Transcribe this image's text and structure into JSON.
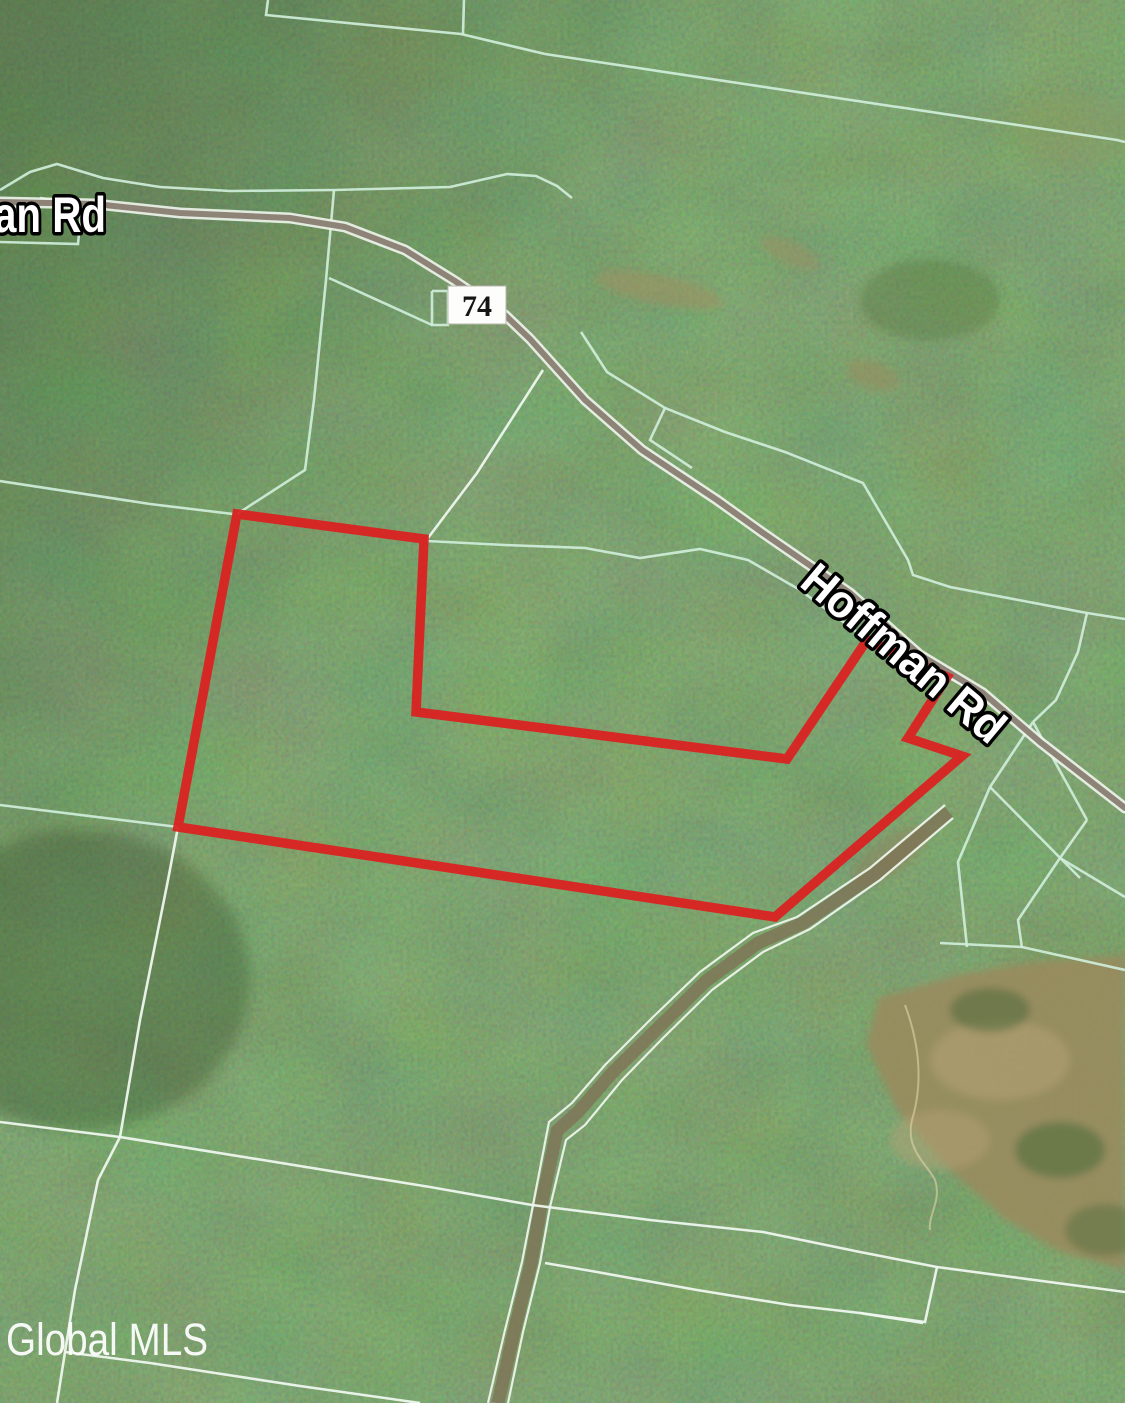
{
  "map": {
    "width": 1125,
    "height": 1403,
    "watermark": "Global MLS",
    "road_label_partial": "an Rd",
    "road_label": "Hoffman Rd",
    "route_badge": "74",
    "colors": {
      "boundary_red": "#db2121",
      "parcel_line_green": "#cfeeda",
      "parcel_line_light": "#eef7ee",
      "road_fill": "#8d8477",
      "road_casing": "#edf3ea",
      "label_fill": "#ffffff",
      "label_outline": "#000000",
      "forest_dark": "#2e4824",
      "forest_light": "#6d8f55",
      "cleared_tan": "#9a8a5e"
    },
    "red_boundary": [
      [
        237,
        514
      ],
      [
        424,
        539
      ],
      [
        416,
        712
      ],
      [
        787,
        759
      ],
      [
        867,
        640
      ],
      [
        947,
        677
      ],
      [
        908,
        738
      ],
      [
        962,
        756
      ],
      [
        775,
        917
      ],
      [
        178,
        827
      ]
    ],
    "road": [
      [
        0,
        202
      ],
      [
        95,
        204
      ],
      [
        180,
        213
      ],
      [
        290,
        218
      ],
      [
        345,
        227
      ],
      [
        405,
        250
      ],
      [
        455,
        281
      ],
      [
        505,
        315
      ],
      [
        530,
        339
      ],
      [
        585,
        400
      ],
      [
        642,
        450
      ],
      [
        717,
        500
      ],
      [
        763,
        533
      ],
      [
        850,
        593
      ],
      [
        920,
        655
      ],
      [
        983,
        693
      ],
      [
        1040,
        742
      ],
      [
        1125,
        808
      ]
    ],
    "green_lines": [
      [
        [
          0,
          190
        ],
        [
          30,
          172
        ],
        [
          57,
          164
        ],
        [
          103,
          178
        ],
        [
          160,
          187
        ],
        [
          230,
          191
        ],
        [
          334,
          190
        ],
        [
          450,
          187
        ],
        [
          507,
          174
        ],
        [
          536,
          176
        ],
        [
          557,
          186
        ],
        [
          572,
          198
        ]
      ],
      [
        [
          0,
          242
        ],
        [
          78,
          244
        ],
        [
          82,
          203
        ],
        [
          40,
          198
        ]
      ],
      [
        [
          334,
          190
        ],
        [
          326,
          280
        ],
        [
          314,
          400
        ],
        [
          305,
          470
        ],
        [
          237,
          514
        ]
      ],
      [
        [
          329,
          278
        ],
        [
          432,
          325
        ]
      ],
      [
        [
          432,
          291
        ],
        [
          448,
          291
        ],
        [
          448,
          325
        ],
        [
          432,
          325
        ],
        [
          432,
          291
        ]
      ],
      [
        [
          268,
          0
        ],
        [
          266,
          15
        ],
        [
          461,
          34
        ],
        [
          545,
          54
        ],
        [
          1117,
          140
        ],
        [
          1125,
          142
        ]
      ],
      [
        [
          464,
          0
        ],
        [
          463,
          34
        ]
      ],
      [
        [
          427,
          541
        ],
        [
          505,
          545
        ],
        [
          585,
          548
        ],
        [
          640,
          558
        ],
        [
          700,
          549
        ],
        [
          748,
          560
        ],
        [
          800,
          590
        ],
        [
          838,
          618
        ],
        [
          867,
          640
        ]
      ],
      [
        [
          947,
          677
        ],
        [
          978,
          692
        ]
      ],
      [
        [
          581,
          332
        ],
        [
          607,
          372
        ],
        [
          665,
          408
        ],
        [
          725,
          432
        ],
        [
          785,
          452
        ],
        [
          863,
          483
        ],
        [
          908,
          560
        ],
        [
          913,
          575
        ],
        [
          950,
          587
        ],
        [
          1087,
          613
        ],
        [
          1125,
          619
        ]
      ],
      [
        [
          1087,
          613
        ],
        [
          1078,
          652
        ],
        [
          1056,
          700
        ],
        [
          1033,
          722
        ]
      ],
      [
        [
          665,
          408
        ],
        [
          650,
          440
        ],
        [
          692,
          468
        ]
      ],
      [
        [
          1033,
          722
        ],
        [
          990,
          787
        ],
        [
          958,
          862
        ],
        [
          967,
          947
        ]
      ],
      [
        [
          1033,
          722
        ],
        [
          1087,
          820
        ]
      ],
      [
        [
          1087,
          820
        ],
        [
          1060,
          858
        ],
        [
          1018,
          920
        ],
        [
          1022,
          948
        ]
      ],
      [
        [
          990,
          787
        ],
        [
          1080,
          878
        ]
      ],
      [
        [
          1060,
          858
        ],
        [
          1125,
          897
        ]
      ],
      [
        [
          940,
          943
        ],
        [
          1022,
          947
        ],
        [
          1125,
          970
        ]
      ],
      [
        [
          0,
          481
        ],
        [
          150,
          504
        ],
        [
          233,
          514
        ]
      ],
      [
        [
          0,
          805
        ],
        [
          178,
          827
        ]
      ]
    ],
    "white_lines": [
      [
        [
          543,
          370
        ],
        [
          477,
          473
        ],
        [
          428,
          538
        ]
      ],
      [
        [
          178,
          827
        ],
        [
          168,
          880
        ],
        [
          140,
          1020
        ],
        [
          120,
          1137
        ]
      ],
      [
        [
          0,
          1122
        ],
        [
          120,
          1137
        ],
        [
          430,
          1187
        ],
        [
          532,
          1205
        ],
        [
          650,
          1220
        ],
        [
          763,
          1232
        ],
        [
          860,
          1252
        ],
        [
          937,
          1267
        ],
        [
          1125,
          1292
        ]
      ],
      [
        [
          545,
          1263
        ],
        [
          597,
          1272
        ],
        [
          697,
          1290
        ],
        [
          790,
          1305
        ],
        [
          860,
          1313
        ],
        [
          923,
          1323
        ]
      ],
      [
        [
          937,
          1267
        ],
        [
          925,
          1322
        ],
        [
          860,
          1313
        ]
      ],
      [
        [
          120,
          1137
        ],
        [
          98,
          1180
        ],
        [
          75,
          1290
        ],
        [
          65,
          1352
        ],
        [
          57,
          1403
        ]
      ],
      [
        [
          65,
          1352
        ],
        [
          150,
          1363
        ],
        [
          300,
          1386
        ],
        [
          420,
          1403
        ]
      ]
    ],
    "trail_center": [
      [
        949,
        812
      ],
      [
        875,
        874
      ],
      [
        803,
        923
      ],
      [
        758,
        943
      ],
      [
        706,
        981
      ],
      [
        658,
        1028
      ],
      [
        613,
        1072
      ],
      [
        578,
        1112
      ],
      [
        557,
        1131
      ],
      [
        541,
        1206
      ],
      [
        531,
        1263
      ],
      [
        514,
        1332
      ],
      [
        498,
        1403
      ]
    ],
    "trail_edges": [
      [
        [
          945,
          805
        ],
        [
          870,
          868
        ],
        [
          797,
          917
        ],
        [
          753,
          933
        ],
        [
          700,
          972
        ],
        [
          652,
          1018
        ],
        [
          605,
          1065
        ],
        [
          572,
          1103
        ],
        [
          549,
          1122
        ],
        [
          533,
          1205
        ],
        [
          522,
          1262
        ],
        [
          505,
          1330
        ],
        [
          488,
          1403
        ]
      ],
      [
        [
          953,
          818
        ],
        [
          880,
          880
        ],
        [
          810,
          929
        ],
        [
          763,
          952
        ],
        [
          712,
          990
        ],
        [
          663,
          1038
        ],
        [
          622,
          1080
        ],
        [
          585,
          1125
        ],
        [
          566,
          1140
        ],
        [
          550,
          1207
        ],
        [
          540,
          1263
        ],
        [
          523,
          1332
        ],
        [
          508,
          1403
        ]
      ]
    ]
  }
}
